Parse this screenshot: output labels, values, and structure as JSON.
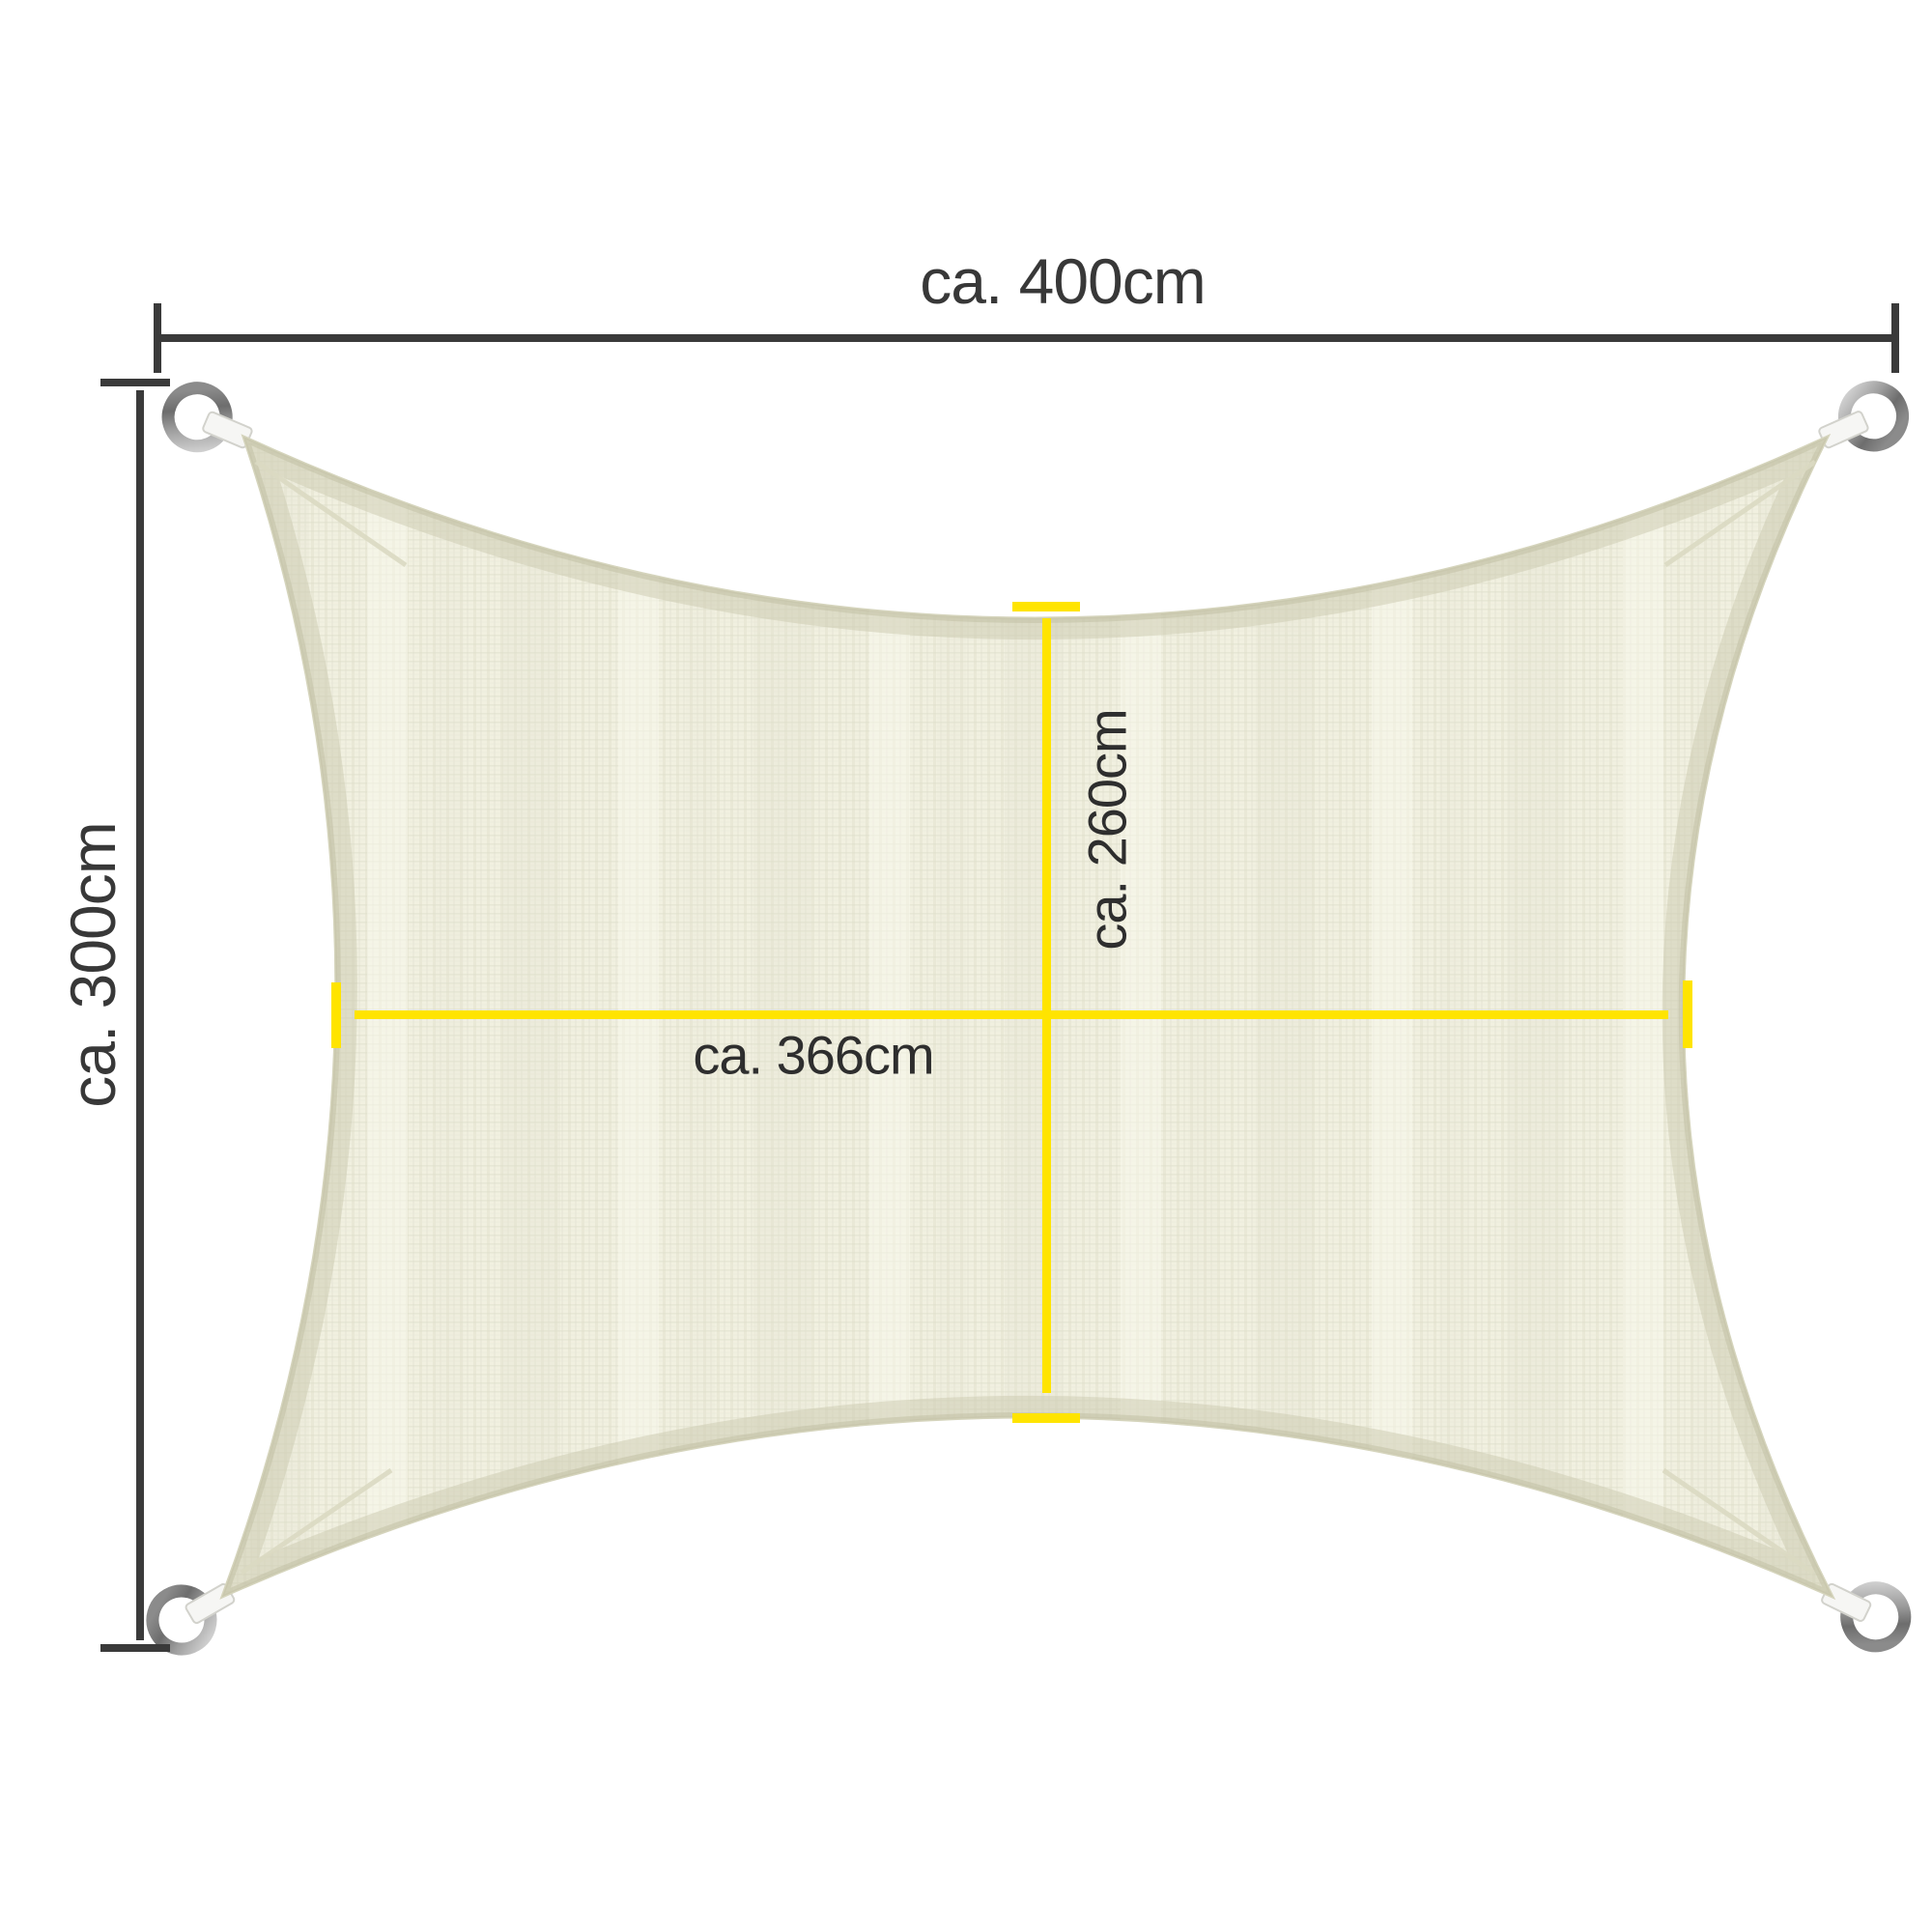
{
  "diagram": {
    "product": "Rectangular shade sail with corner D-rings",
    "labels": {
      "outer_width": "ca. 400cm",
      "outer_height": "ca. 300cm",
      "inner_width": "ca. 366cm",
      "inner_height": "ca. 260cm"
    },
    "colors": {
      "background": "#ffffff",
      "outer_dimension_line": "#3a3a3a",
      "inner_dimension_line": "#ffe400",
      "fabric": "#f1f0e0",
      "fabric_hem": "#cbcab0",
      "ring_metal": "#9c9c9c",
      "strap": "#f6f6f4",
      "label_text": "#383838"
    },
    "icons": [
      {
        "name": "d-ring-top-left-icon"
      },
      {
        "name": "d-ring-top-right-icon"
      },
      {
        "name": "d-ring-bottom-left-icon"
      },
      {
        "name": "d-ring-bottom-right-icon"
      }
    ]
  }
}
